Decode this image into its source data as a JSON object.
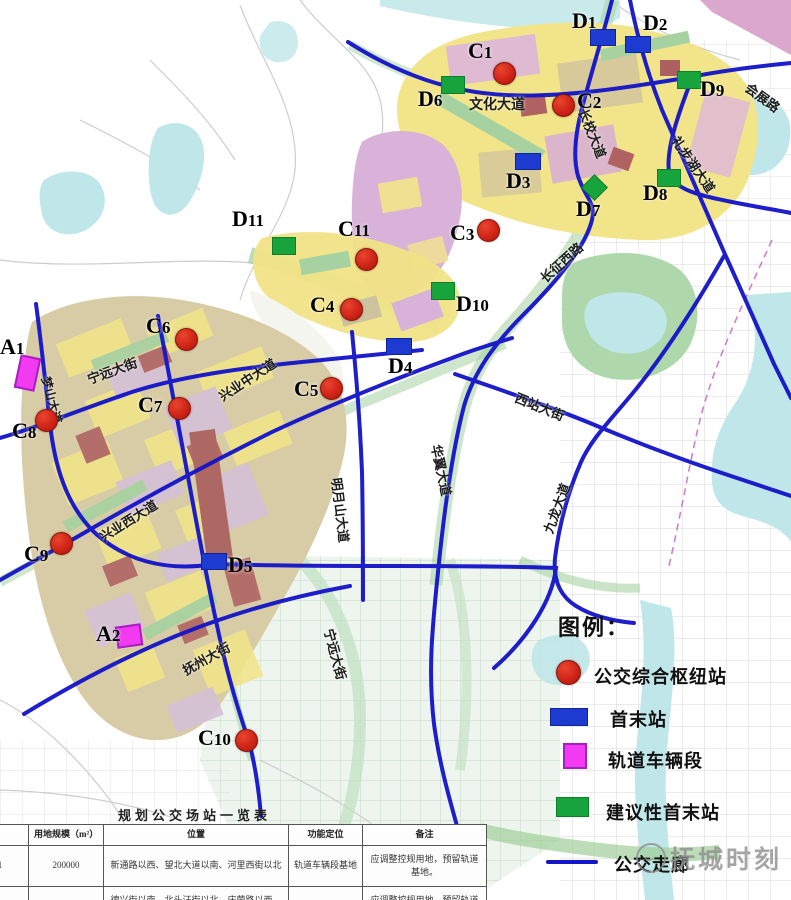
{
  "colors": {
    "route_blue": "#1515c8",
    "hub_red": "#cf2417",
    "terminal_blue": "#1d3bd0",
    "suggested_green": "#17a43c",
    "depot_magenta": "#f23af2",
    "zone_yellow": "#f2e489",
    "zone_lavender": "#d9b2d9",
    "zone_tan": "#d8cca6",
    "water_teal": "#bfe6e8",
    "park_green": "#aed7ab"
  },
  "map": {
    "road_labels": [
      {
        "key": "wenhua-dadao",
        "text": "文化大道",
        "x": 497,
        "y": 104,
        "rot": 0,
        "size": 14
      },
      {
        "key": "changxiao-dadao",
        "text": "长校大道",
        "x": 593,
        "y": 133,
        "rot": 68,
        "size": 13
      },
      {
        "key": "huizhan-lu",
        "text": "会展路",
        "x": 763,
        "y": 97,
        "rot": 36,
        "size": 13
      },
      {
        "key": "libuhu-dadao",
        "text": "礼步湖大道",
        "x": 694,
        "y": 164,
        "rot": 55,
        "size": 13
      },
      {
        "key": "changzheng-xilu",
        "text": "长征西路",
        "x": 561,
        "y": 262,
        "rot": -42,
        "size": 13
      },
      {
        "key": "xizhan-dajie",
        "text": "西站大街",
        "x": 540,
        "y": 406,
        "rot": 22,
        "size": 13
      },
      {
        "key": "huayi-dadao",
        "text": "华翼大道",
        "x": 442,
        "y": 470,
        "rot": 78,
        "size": 13
      },
      {
        "key": "jiulong-dadao",
        "text": "九龙大道",
        "x": 556,
        "y": 508,
        "rot": -70,
        "size": 13
      },
      {
        "key": "mingyueshan-dadao",
        "text": "明月山大道",
        "x": 341,
        "y": 510,
        "rot": 83,
        "size": 13
      },
      {
        "key": "ningyuan-dajie-w",
        "text": "宁远大街",
        "x": 112,
        "y": 370,
        "rot": -20,
        "size": 13
      },
      {
        "key": "ningyuan-dajie-s",
        "text": "宁远大街",
        "x": 336,
        "y": 654,
        "rot": 75,
        "size": 13
      },
      {
        "key": "mengshan-dadao",
        "text": "梦山大道",
        "x": 52,
        "y": 400,
        "rot": 75,
        "size": 12
      },
      {
        "key": "xingye-zhong-dadao",
        "text": "兴业中大道",
        "x": 247,
        "y": 379,
        "rot": -33,
        "size": 13
      },
      {
        "key": "xingye-xi-dadao",
        "text": "兴业西大道",
        "x": 128,
        "y": 520,
        "rot": -32,
        "size": 13
      },
      {
        "key": "fuzhou-dajie",
        "text": "抚州大街",
        "x": 206,
        "y": 658,
        "rot": -29,
        "size": 13
      }
    ],
    "markers": {
      "hubs": [
        {
          "id": "C1",
          "x": 503,
          "y": 72,
          "lx": 468,
          "ly": 40
        },
        {
          "id": "C2",
          "x": 562,
          "y": 104,
          "lx": 577,
          "ly": 90
        },
        {
          "id": "C3",
          "x": 487,
          "y": 229,
          "lx": 450,
          "ly": 222
        },
        {
          "id": "C4",
          "x": 350,
          "y": 308,
          "lx": 310,
          "ly": 294
        },
        {
          "id": "C5",
          "x": 330,
          "y": 387,
          "lx": 294,
          "ly": 378
        },
        {
          "id": "C6",
          "x": 185,
          "y": 338,
          "lx": 146,
          "ly": 315
        },
        {
          "id": "C7",
          "x": 178,
          "y": 407,
          "lx": 138,
          "ly": 394
        },
        {
          "id": "C8",
          "x": 45,
          "y": 419,
          "lx": 12,
          "ly": 420
        },
        {
          "id": "C9",
          "x": 60,
          "y": 542,
          "lx": 24,
          "ly": 543
        },
        {
          "id": "C10",
          "x": 245,
          "y": 739,
          "lx": 198,
          "ly": 727
        },
        {
          "id": "C11",
          "x": 365,
          "y": 258,
          "lx": 338,
          "ly": 218
        }
      ],
      "terminals": [
        {
          "id": "D1",
          "x": 602,
          "y": 37,
          "lx": 572,
          "ly": 10
        },
        {
          "id": "D2",
          "x": 637,
          "y": 44,
          "lx": 643,
          "ly": 12
        },
        {
          "id": "D3",
          "x": 527,
          "y": 161,
          "lx": 506,
          "ly": 170
        },
        {
          "id": "D4",
          "x": 398,
          "y": 346,
          "lx": 388,
          "ly": 355
        },
        {
          "id": "D5",
          "x": 213,
          "y": 561,
          "lx": 228,
          "ly": 554
        }
      ],
      "suggested": [
        {
          "id": "D6",
          "x": 452,
          "y": 84,
          "lx": 418,
          "ly": 88,
          "shape": "square"
        },
        {
          "id": "D7",
          "x": 596,
          "y": 186,
          "lx": 576,
          "ly": 198,
          "shape": "diamond"
        },
        {
          "id": "D8",
          "x": 668,
          "y": 177,
          "lx": 643,
          "ly": 182,
          "shape": "square"
        },
        {
          "id": "D9",
          "x": 688,
          "y": 79,
          "lx": 700,
          "ly": 78,
          "shape": "square"
        },
        {
          "id": "D10",
          "x": 442,
          "y": 290,
          "lx": 456,
          "ly": 293,
          "shape": "square"
        },
        {
          "id": "D11",
          "x": 283,
          "y": 245,
          "lx": 232,
          "ly": 208,
          "shape": "square"
        }
      ],
      "depots": [
        {
          "id": "A1",
          "x": 25,
          "y": 371,
          "w": 17,
          "h": 30,
          "rot": 12,
          "lx": 0,
          "ly": 336
        },
        {
          "id": "A2",
          "x": 127,
          "y": 634,
          "w": 22,
          "h": 18,
          "rot": -8,
          "lx": 96,
          "ly": 623
        }
      ]
    }
  },
  "legend": {
    "title": "图例：",
    "items": [
      {
        "key": "hub",
        "symbol": "hub-circle",
        "label": "公交综合枢纽站",
        "sx": 556,
        "sy": 660,
        "tx": 594,
        "ty": 663
      },
      {
        "key": "terminal",
        "symbol": "terminal-square",
        "label": "首末站",
        "sx": 550,
        "sy": 708,
        "tx": 610,
        "ty": 706
      },
      {
        "key": "depot",
        "symbol": "depot-square",
        "label": "轨道车辆段",
        "sx": 563,
        "sy": 743,
        "tx": 608,
        "ty": 747
      },
      {
        "key": "suggested",
        "symbol": "suggested-square",
        "label": "建议性首末站",
        "sx": 556,
        "sy": 797,
        "tx": 606,
        "ty": 799
      },
      {
        "key": "corridor",
        "symbol": "route-line",
        "label": "公交走廊",
        "sx": 546,
        "sy": 860,
        "tx": 614,
        "ty": 851
      }
    ]
  },
  "watermark": {
    "text": "抚城时刻"
  },
  "table": {
    "title": "规划公交场站一览表",
    "headers": [
      "",
      "用地规模（m²）",
      "位置",
      "功能定位",
      "备注"
    ],
    "col_widths": [
      75,
      75,
      185,
      74,
      124
    ],
    "rows": [
      [
        "基地1",
        "200000",
        "新通路以西、望北大道以南、河里西街以北",
        "轨道车辆段基地",
        "应调整控规用地，预留轨道基地。"
      ],
      [
        "基地2",
        "284000",
        "德兴街以南、北头汪街以北、庆荣路以西、兴",
        "轨道车辆段基地",
        "应调整控规用地，预留轨道基地。"
      ]
    ]
  }
}
